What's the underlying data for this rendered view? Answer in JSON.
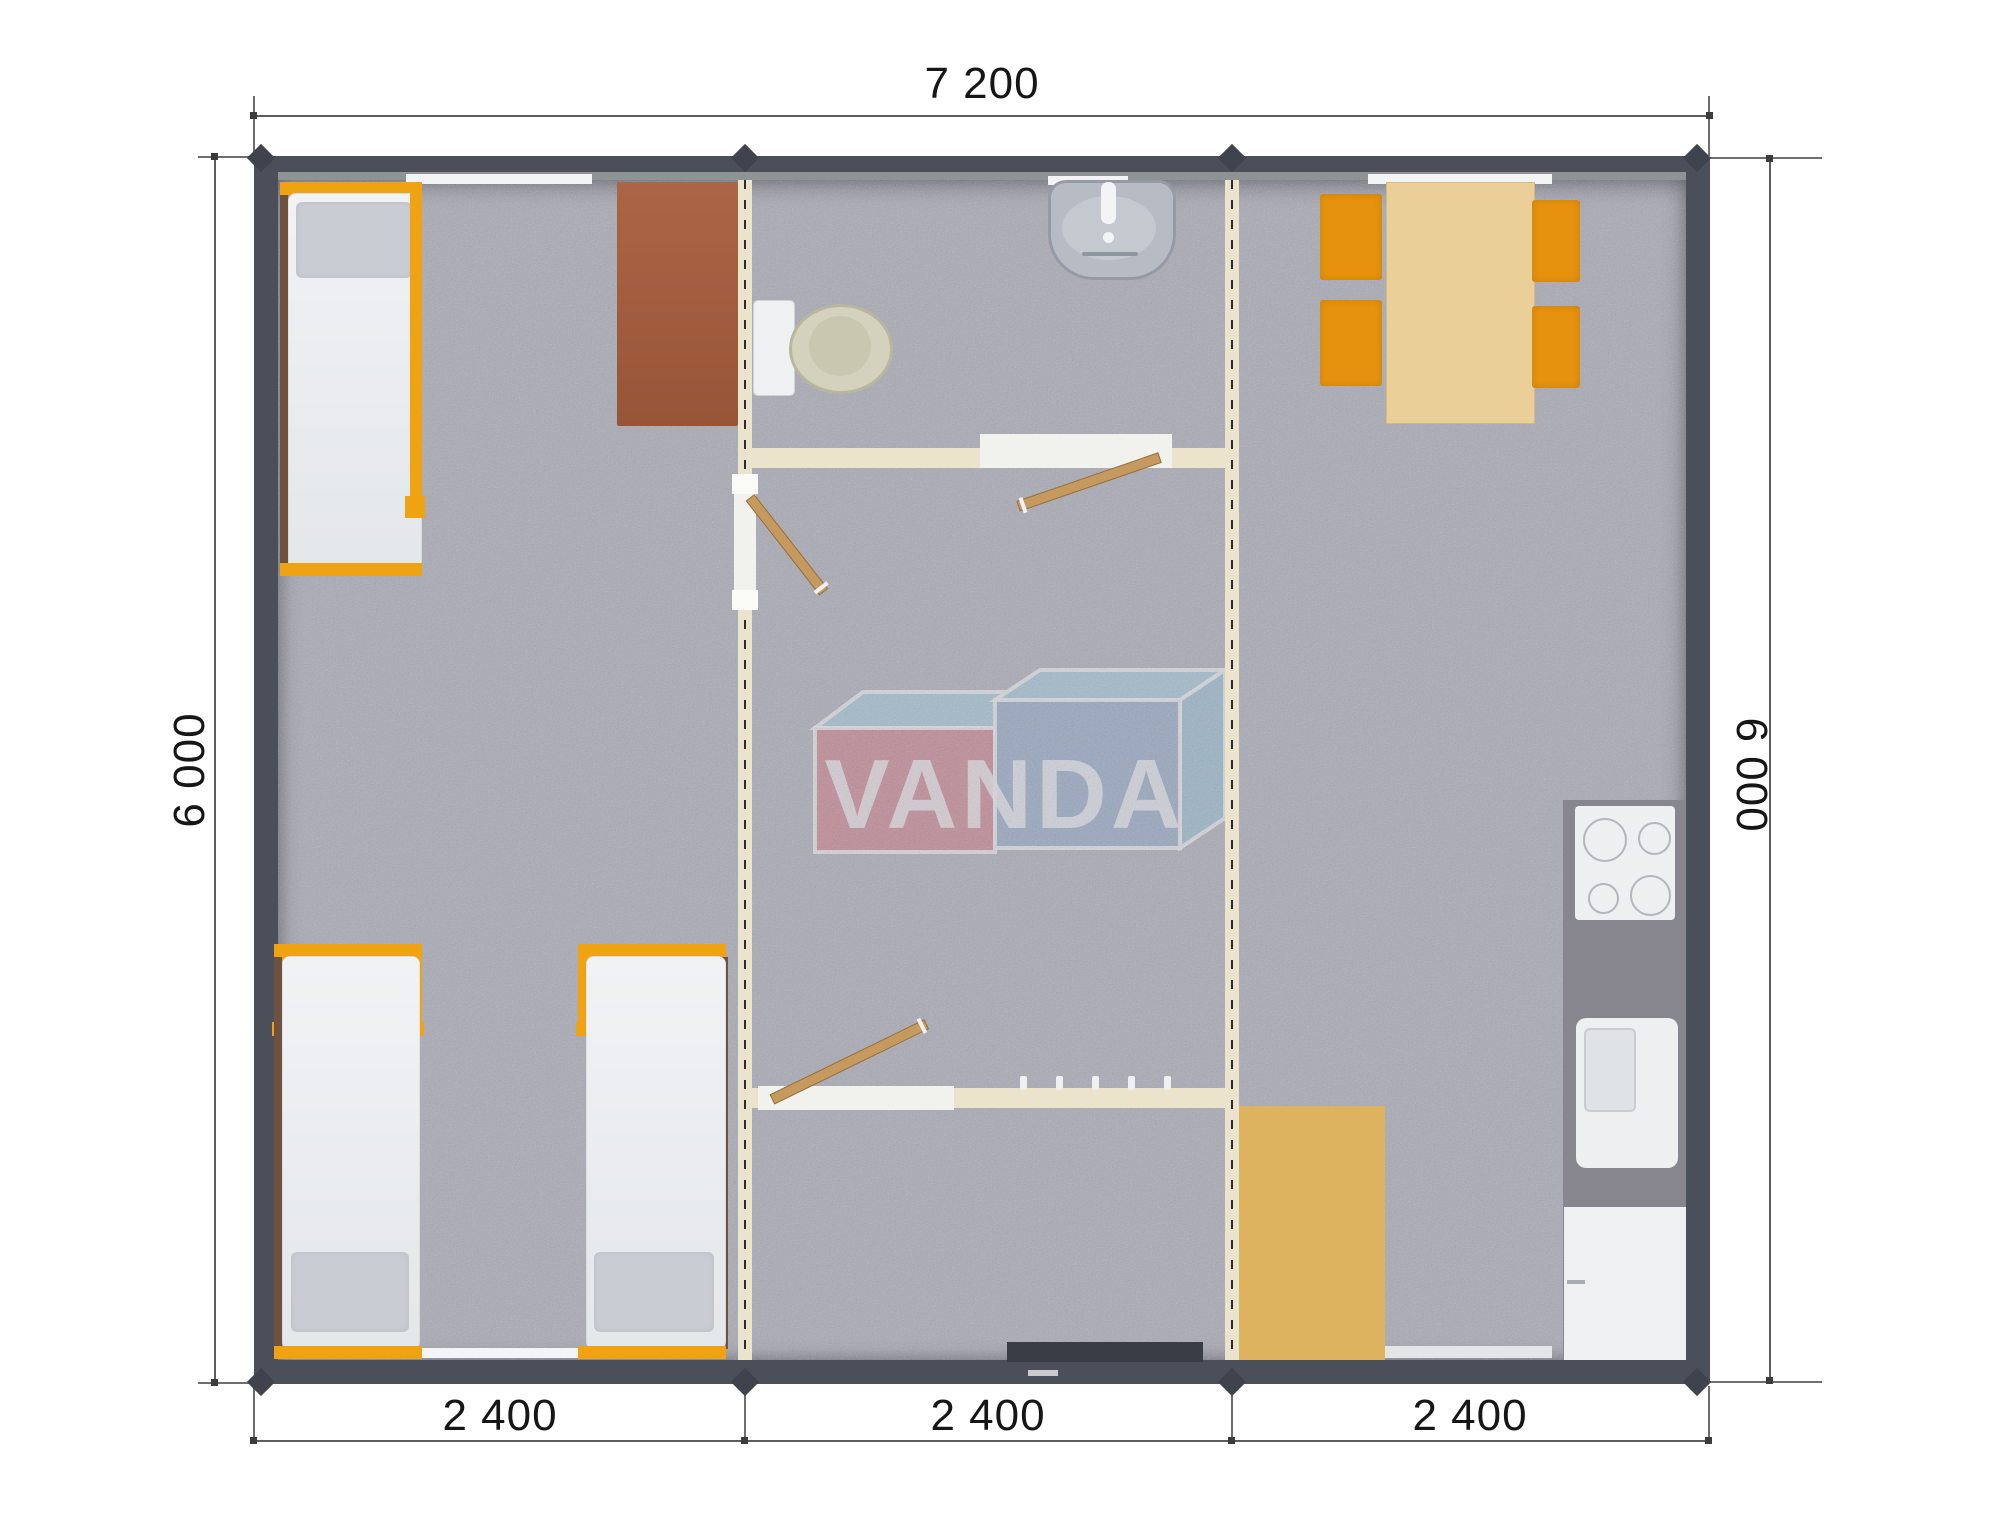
{
  "watermark": {
    "text": "VANDA"
  },
  "dimensions": {
    "top_width": "7 200",
    "left_height": "6 000",
    "right_height": "6 000",
    "bottom_widths": [
      "2 400",
      "2 400",
      "2 400"
    ]
  },
  "colors": {
    "wall": "#4a4f59",
    "floor": "#a9aab4",
    "partition": "#ebe3cb",
    "accent_orange": "#e6920e",
    "wood_light": "#eacf98",
    "wood_mat": "#ddb35f",
    "wood_door": "#c69a5f",
    "desk_brown": "#a55c3b",
    "logo_red": "#d2737f",
    "logo_blue": "#8ba6c6",
    "logo_light_blue": "#9ccadc"
  },
  "plan": {
    "type": "modular-cabin-floor-plan",
    "modules": 3,
    "furniture": [
      "bed",
      "bed",
      "bed",
      "desk",
      "toilet",
      "wash-basin",
      "interior-door",
      "interior-door",
      "interior-door",
      "coat-hooks",
      "dining-table",
      "chair",
      "chair",
      "chair",
      "chair",
      "cooktop",
      "kitchen-sink",
      "kitchen-cabinet",
      "kitchen-counter",
      "floor-mat"
    ]
  }
}
